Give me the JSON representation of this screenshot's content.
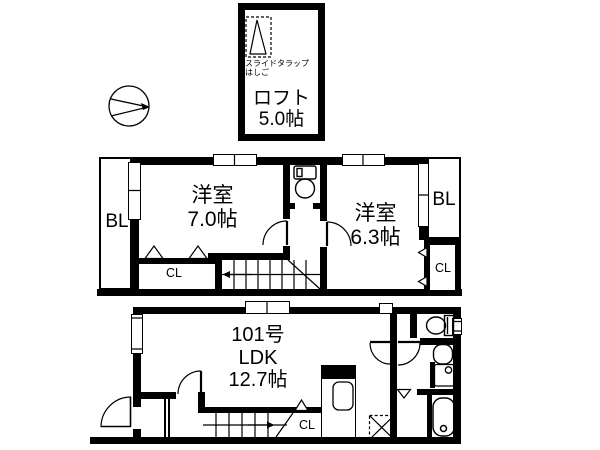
{
  "meta": {
    "kind": "japanese-floor-plan",
    "unit_suffix": "帖"
  },
  "colors": {
    "wall": "#000000",
    "background": "#ffffff"
  },
  "loft": {
    "ladder_line1": "スライドタラップ",
    "ladder_line2": "はしご",
    "name": "ロフト",
    "size": "5.0帖"
  },
  "floor2": {
    "room1": {
      "name": "洋室",
      "size": "7.0帖"
    },
    "room2": {
      "name": "洋室",
      "size": "6.3帖"
    },
    "balcony_left": "BL",
    "balcony_right": "BL",
    "closet_left": "CL",
    "closet_right": "CL"
  },
  "floor1": {
    "unit": "101号",
    "room": "LDK",
    "size": "12.7帖",
    "closet": "CL"
  }
}
